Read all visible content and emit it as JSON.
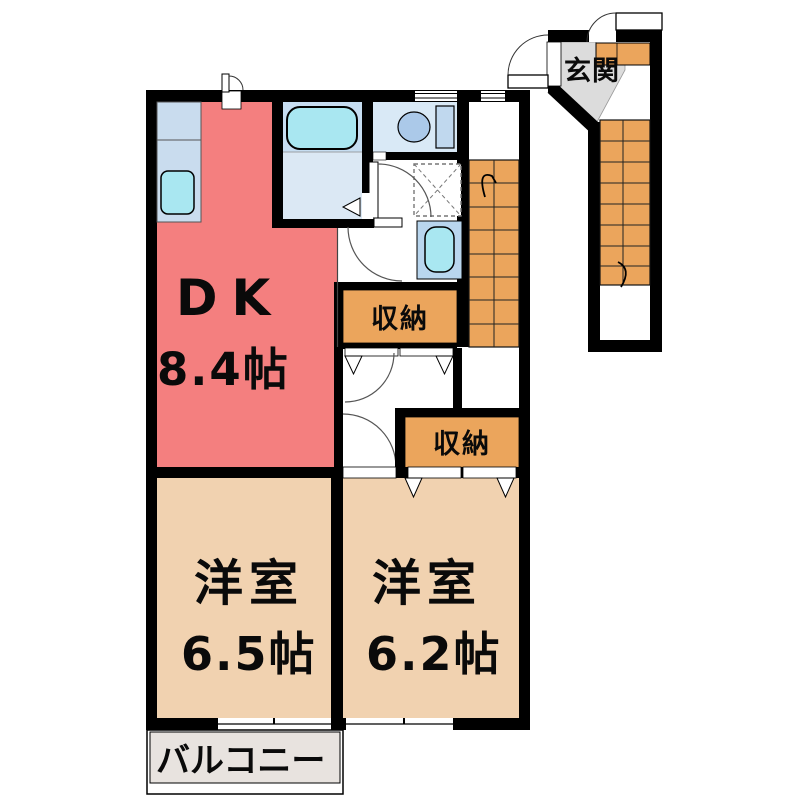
{
  "plan": {
    "rooms": {
      "dk": {
        "label": "DK",
        "size": "8.4帖"
      },
      "west_room_1": {
        "label": "洋室",
        "size": "6.5帖"
      },
      "west_room_2": {
        "label": "洋室",
        "size": "6.2帖"
      },
      "closet_1": {
        "label": "収納"
      },
      "closet_2": {
        "label": "収納"
      },
      "entrance": {
        "label": "玄関"
      },
      "balcony": {
        "label": "バルコニー"
      }
    },
    "fixtures": {
      "kitchen_sink": "kitchen-sink",
      "bathtub": "bathtub",
      "toilet": "toilet",
      "washbasin": "washbasin",
      "washing_machine_pan": "washing-machine-pan",
      "inner_stairs": "staircase-up",
      "outer_stairs": "staircase-down"
    },
    "colors": {
      "wall": "#000000",
      "dk_floor": "#f47f7f",
      "room_floor": "#f1d2b0",
      "storage": "#eba55c",
      "stairs": "#eba55c",
      "balcony_floor": "#e8e3df",
      "entrance_floor": "#dcdcdc",
      "water_fixture": "#a9e7f1",
      "counter": "#c9dcee",
      "bath_upper": "#c6ddf1",
      "bath_floor": "#dbe8f4",
      "toilet_floor": "#d9e9f6",
      "toilet_tank": "#c0d8ee",
      "toilet_bowl": "#abc9e9",
      "basin_cabinet": "#b9d6ee"
    }
  }
}
